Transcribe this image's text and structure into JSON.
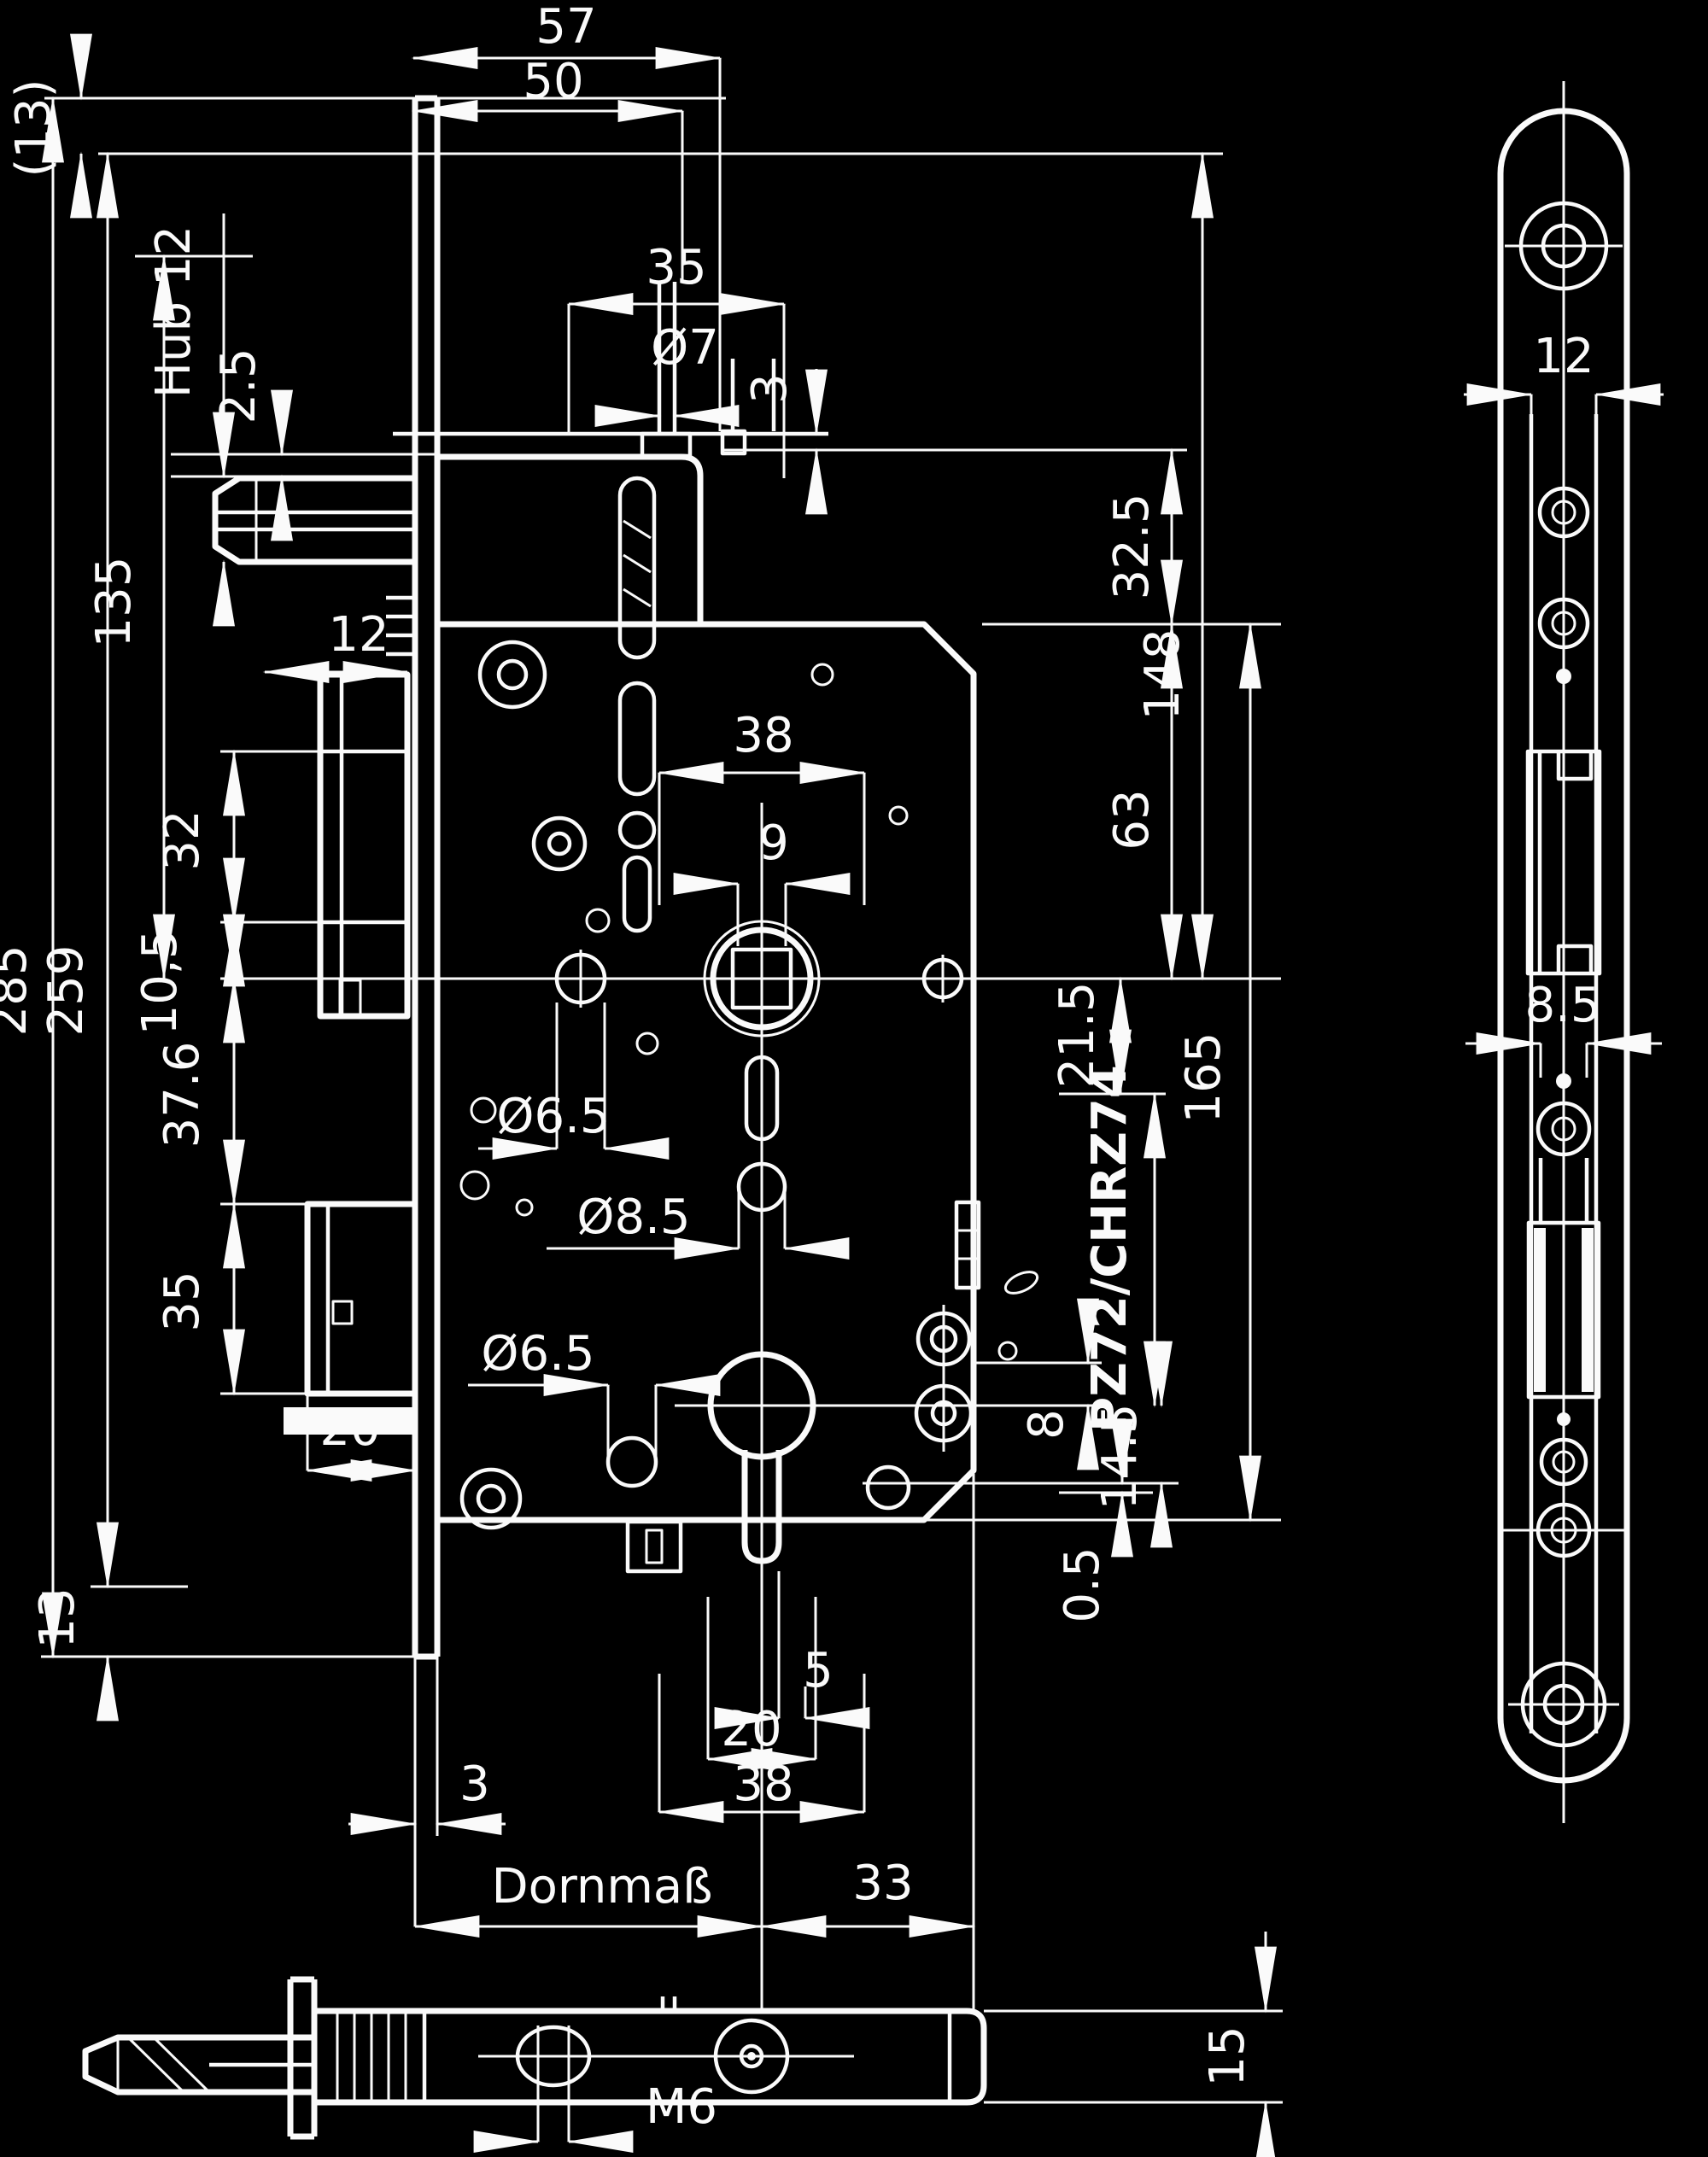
{
  "drawing": {
    "kind": "mortise-lock dimensioned technical drawing",
    "colors": {
      "background": "#000000",
      "line": "#fafafa"
    }
  },
  "dims": {
    "d57": "57",
    "d50": "50",
    "d35_top": "35",
    "dia7": "Ø7",
    "d3_top": "3",
    "d13_top": "(13)",
    "hub12": "Hub 12",
    "d2_5": "2.5",
    "d135": "135",
    "d285": "285",
    "d259": "259",
    "d13_bot": "13",
    "d12_aux": "12",
    "d32": "32",
    "d10_5": "10,5",
    "d37_6": "37.6",
    "d35_bolt": "35",
    "d20_bolt": "20",
    "d38_top": "38",
    "d9": "9",
    "dia6_5a": "Ø6.5",
    "dia8_5": "Ø8.5",
    "dia6_5b": "Ø6.5",
    "d32_5": "32.5",
    "d148": "148",
    "d63": "63",
    "d165": "165",
    "d21_5": "21.5",
    "pz": "PZ72/CHRZ74",
    "d8": "8",
    "d14_5": "14.5",
    "d0_5": "0.5",
    "d5": "5",
    "d20_cyl": "20",
    "d38_cyl": "38",
    "d3_stulp": "3",
    "dornmass": "Dornmaß",
    "d33": "33",
    "d12_plate": "12",
    "d8_5_plate": "8.5",
    "m6": "M6",
    "d15": "15"
  }
}
